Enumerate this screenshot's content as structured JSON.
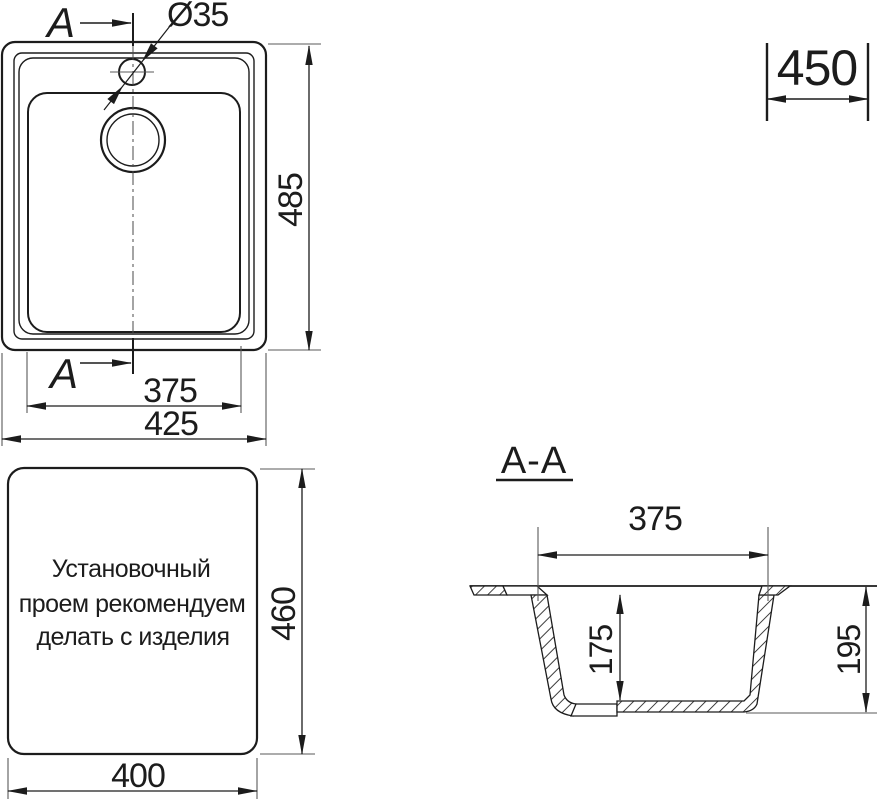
{
  "drawing_title": "Sink installation drawing",
  "colors": {
    "line": "#1c1c1c",
    "dim": "#2b2b2b",
    "ext": "#5a5a5a",
    "bg": "#ffffff"
  },
  "plan_view": {
    "section_label_top": "A",
    "section_label_bottom": "A",
    "faucet_hole_diameter": "Ø35",
    "dim_height": "485",
    "dim_inner_width": "375",
    "dim_outer_width": "425"
  },
  "cabinet_callout": {
    "dim_cabinet_width": "450"
  },
  "install_view": {
    "note_lines": [
      "Установочный",
      "проем рекомендуем",
      "делать с изделия"
    ],
    "dim_height": "460",
    "dim_width": "400"
  },
  "section_view": {
    "title": "A-A",
    "dim_top_width": "375",
    "dim_bowl_depth": "175",
    "dim_total_depth": "195"
  }
}
